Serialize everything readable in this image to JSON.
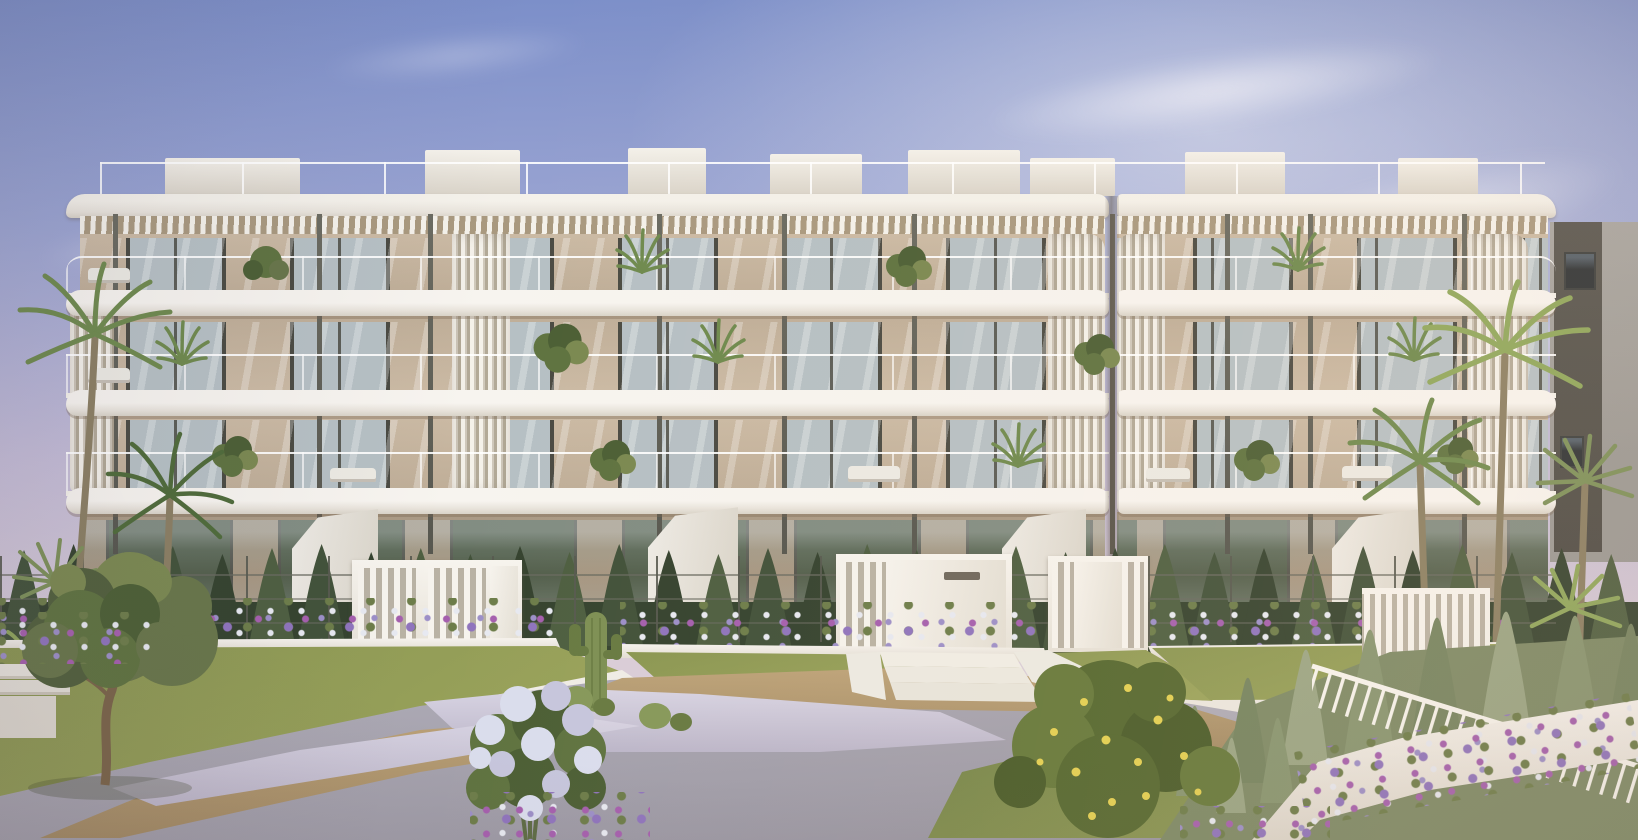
{
  "scene": {
    "type": "architectural-exterior-render",
    "subject": "modern four-storey white apartment building with pergola roof terraces, glass balconies and landscaped mediterranean garden",
    "elements": [
      "sky",
      "wispy-clouds",
      "neighboring-grey-building",
      "palm-trees",
      "pergola-slat-roof",
      "rooftop-glass-railing",
      "glass-balustrade-balconies",
      "vertical-louver-screens",
      "floor-to-ceiling-windows",
      "ground-floor-terraces",
      "cypress-hedge",
      "wire-garden-fence",
      "white-entrance-gates",
      "entrance-steps",
      "flower-beds",
      "terraced-lawns",
      "retaining-walls",
      "olive-tree",
      "white-flowering-shrub",
      "lemon-shrub",
      "saguaro-cactus",
      "barrel-cacti",
      "juniper-slope",
      "white-railing-fence",
      "concrete-path",
      "dirt-path",
      "white-gravel"
    ]
  },
  "palette": {
    "sky_top": "#7c8fc9",
    "sky_mid": "#9aa4d2",
    "sky_low": "#c4bcd6",
    "sky_warm": "#d9cdd8",
    "cloud_white": "rgba(250,250,255,0.85)",
    "bgb_light": "#a8a6a2",
    "bgb_dark": "#585650",
    "bgb_win": "#2e3336",
    "white_sun": "#f4f1ea",
    "white_mid": "#e9e4dc",
    "white_shade": "#d9d3c8",
    "wall_light": "#cbbaa4",
    "wall_mid": "#bfae98",
    "wall_dark": "#ab9b86",
    "wall_ground": "#a4947f",
    "wall_under": "#a9997f",
    "frame": "#4b4b43",
    "glass_up": "#b6c0c4",
    "glass_gr": "#535f4c",
    "hedge_d": "#35432f",
    "hedge_m": "#42523a",
    "hedge_l": "#4e5f41",
    "grass_sun": "#9aa35b",
    "grass_mid": "#8a9652",
    "grass_sh": "#76854a",
    "juniper_l": "#9aa584",
    "juniper_m": "#879570",
    "juniper_d": "#758460",
    "olive_l": "#7b8951",
    "olive_m": "#68764a",
    "olive_d": "#51603c",
    "trunk": "#7a6449",
    "leaf": "#5f7340",
    "leaf_d": "#4c5f35",
    "bloom": "#dadded",
    "bloom2": "#c6c6dd",
    "lemon_leaf": "#556830",
    "lemon_leaf2": "#66793b",
    "lemon": "#e2cf52",
    "fl_mag": "#a55fae",
    "fl_vio": "#8f74bd",
    "fl_wht": "#e7e9f1",
    "fl_grn": "#6d7d4a",
    "fl_lav": "#9c8fc8",
    "dirt": "#b29a75",
    "dirt_d": "#a28a64",
    "gravel": "#d3cfde",
    "gravel_d": "#bcb6c9",
    "conc": "#aaa7b2",
    "conc_d": "#9996a2",
    "cactus": "#7e9054",
    "cactus_d": "#687a42",
    "post": "#57574f",
    "rail": "#f7f4ee",
    "palm_light": "#8fa75c",
    "palm_mid": "#6f8a4e",
    "palm_dark": "#4f6b3a",
    "palm_fan": "#7d915a",
    "palm_trunk": "#8b7f63"
  }
}
